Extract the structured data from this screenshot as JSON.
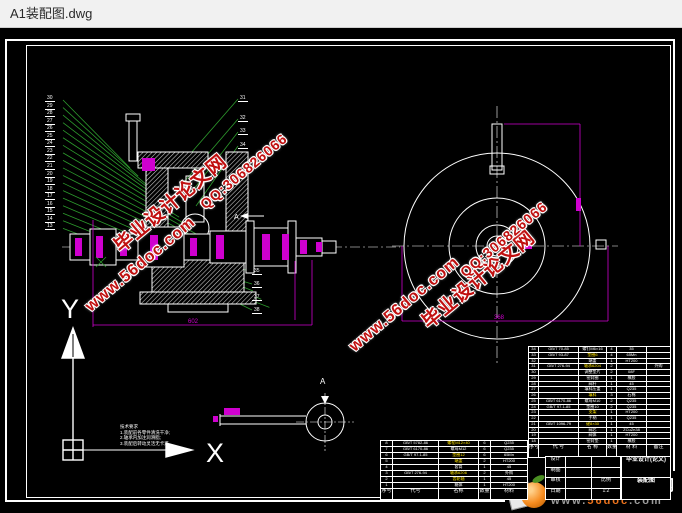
{
  "window": {
    "title": "A1装配图.dwg"
  },
  "watermark": {
    "site": "毕业设计论文网",
    "url": "www.56doc.com",
    "qq": "QQ:306826066"
  },
  "logo": {
    "site": "毕业设计论文网",
    "www": "www.",
    "domain": "56doc",
    "tld": ".com"
  },
  "views": {
    "section_label": "A",
    "detail_label": "A"
  },
  "ucs": {
    "y": "Y",
    "x": "X"
  },
  "dims": {
    "main_width": "602",
    "front_width": "368"
  },
  "notes": [
    "技术要求",
    "1.装配前各零件清洗干净;",
    "2.轴承内加注润滑脂;",
    "3.装配后转动灵活无卡滞"
  ],
  "callouts": {
    "left": [
      "30",
      "29",
      "28",
      "27",
      "26",
      "25",
      "24",
      "23",
      "22",
      "21",
      "20",
      "19",
      "18",
      "17",
      "16",
      "15",
      "14",
      "13"
    ],
    "top_right": [
      "31",
      "32",
      "33",
      "34"
    ],
    "bottom_right": [
      "35",
      "36",
      "37",
      "38"
    ]
  },
  "bom_header": [
    "序号",
    "代  号",
    "名  称",
    "数量",
    "材  料",
    "备注"
  ],
  "bom_right": {
    "rows": [
      [
        "34",
        "GB/T 70-85",
        "螺钉M6×16",
        "4",
        "35",
        ""
      ],
      [
        "33",
        "GB/T 93-87",
        "垫圈6",
        "4",
        "65Mn",
        ""
      ],
      [
        "32",
        "",
        "端盖",
        "1",
        "HT200",
        ""
      ],
      [
        "31",
        "GB/T 276-94",
        "轴承6204",
        "2",
        "",
        "外购"
      ],
      [
        "30",
        "",
        "调整垫片",
        "2",
        "08F",
        ""
      ],
      [
        "29",
        "",
        "密封圈",
        "1",
        "橡胶",
        ""
      ],
      [
        "28",
        "",
        "阀杆",
        "1",
        "45",
        ""
      ],
      [
        "27",
        "",
        "填料压盖",
        "1",
        "Q235",
        ""
      ],
      [
        "26",
        "",
        "填料",
        "3",
        "石棉",
        ""
      ],
      [
        "25",
        "GB/T 6170-86",
        "螺母M10",
        "2",
        "Q235",
        ""
      ],
      [
        "24",
        "GB/T 97.1-85",
        "垫圈10",
        "2",
        "Q235",
        ""
      ],
      [
        "23",
        "",
        "支架",
        "1",
        "HT200",
        ""
      ],
      [
        "22",
        "",
        "手柄",
        "1",
        "Q235",
        ""
      ],
      [
        "21",
        "GB/T 1096-79",
        "键8×30",
        "1",
        "45",
        ""
      ],
      [
        "20",
        "",
        "阀芯",
        "1",
        "ZCuZn38",
        ""
      ],
      [
        "19",
        "",
        "阀体",
        "1",
        "HT200",
        ""
      ],
      [
        "18",
        "",
        "密封垫",
        "1",
        "橡胶",
        ""
      ]
    ],
    "highlight_rows": [
      1,
      3,
      8,
      11,
      13
    ]
  },
  "bom_left_header": [
    "序号",
    "代号",
    "名称",
    "数量",
    "材料"
  ],
  "bom_left": {
    "rows": [
      [
        "8",
        "GB/T 5782-86",
        "螺栓M12×40",
        "6",
        "Q235"
      ],
      [
        "7",
        "GB/T 6170-86",
        "螺母M12",
        "6",
        "Q235"
      ],
      [
        "6",
        "GB/T 97.1-85",
        "垫圈12",
        "6",
        "65Mn"
      ],
      [
        "5",
        "",
        "端盖",
        "2",
        "HT200"
      ],
      [
        "4",
        "",
        "套筒",
        "1",
        "45"
      ],
      [
        "3",
        "GB/T 276-94",
        "轴承6206",
        "2",
        "外购"
      ],
      [
        "2",
        "",
        "齿轮轴",
        "1",
        "45"
      ],
      [
        "1",
        "",
        "箱体",
        "1",
        "HT200"
      ]
    ],
    "highlight_rows": [
      0,
      2,
      3,
      5,
      6
    ]
  },
  "title_block": {
    "left_rows": [
      [
        "设计",
        "",
        ""
      ],
      [
        "制图",
        "",
        ""
      ],
      [
        "审核",
        "",
        "比例"
      ],
      [
        "日期",
        "",
        "1:2"
      ]
    ],
    "right_rows": [
      [
        "毕业设计(论文)"
      ],
      [
        "装配图"
      ]
    ]
  }
}
